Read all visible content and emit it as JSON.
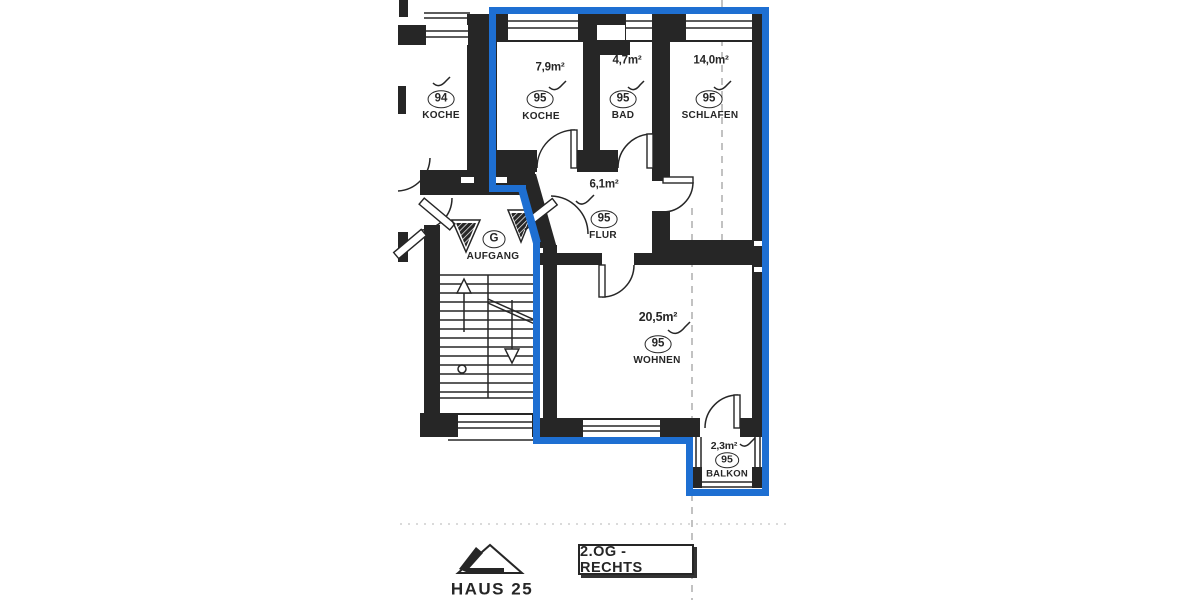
{
  "colors": {
    "ink": "#262626",
    "blue": "#1e6fd2",
    "paper": "#ffffff",
    "shadow": "#333333"
  },
  "apartment_highlighted": {
    "unit": "95"
  },
  "rooms": [
    {
      "unit": "95",
      "name": "KOCHE",
      "area": "7,9m²"
    },
    {
      "unit": "95",
      "name": "BAD",
      "area": "4,7m²"
    },
    {
      "unit": "95",
      "name": "SCHLAFEN",
      "area": "14,0m²"
    },
    {
      "unit": "95",
      "name": "FLUR",
      "area": "6,1m²"
    },
    {
      "unit": "95",
      "name": "WOHNEN",
      "area": "20,5m²"
    },
    {
      "unit": "95",
      "name": "BALKON",
      "area": "2,3m²"
    }
  ],
  "neighbor_room": {
    "unit": "94",
    "name": "KOCHE"
  },
  "stairwell": {
    "unit": "G",
    "name": "AUFGANG"
  },
  "footer": {
    "house_label": "HAUS 25",
    "floor_label": "2.OG - RECHTS"
  }
}
